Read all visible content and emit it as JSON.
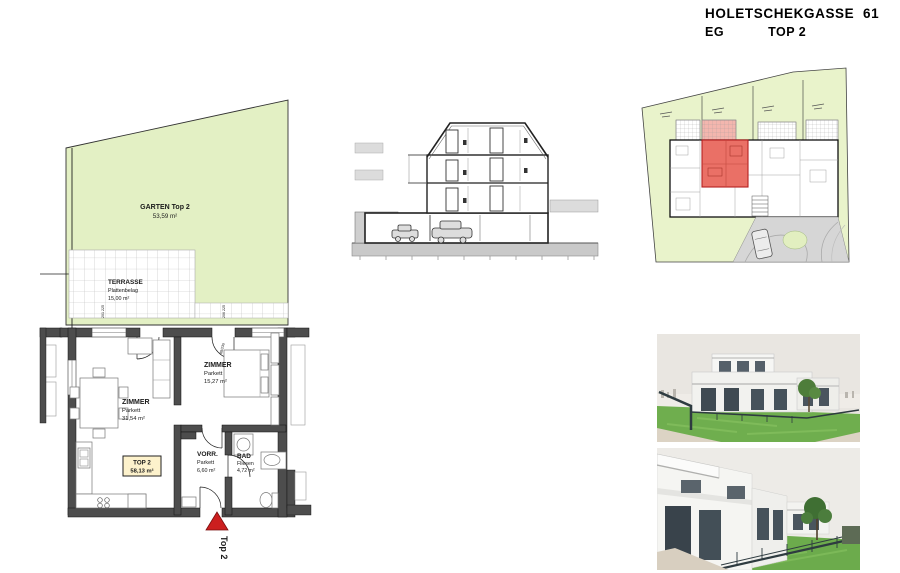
{
  "header": {
    "title": "HOLETSCHEKGASSE  61",
    "floor": "EG",
    "unit": "TOP 2"
  },
  "floor_plan": {
    "garden": {
      "name": "GARTEN Top 2",
      "area": "53,59 m²"
    },
    "terrace": {
      "name": "TERRASSE",
      "finish": "Plattenbelag",
      "area": "15,00 m²"
    },
    "living_room": {
      "name": "ZIMMER",
      "finish": "Parkett",
      "area": "31,54 m²"
    },
    "bedroom": {
      "name": "ZIMMER",
      "finish": "Parkett",
      "area": "15,27 m²"
    },
    "hall": {
      "name": "VORR.",
      "finish": "Parkett",
      "area": "6,60 m²"
    },
    "bath": {
      "name": "BAD",
      "finish": "Fliesen",
      "area": "4,72 m²"
    },
    "unit_box": {
      "label": "TOP 2",
      "area": "58,13 m²"
    },
    "entrance_marker": "Top 2",
    "dims": {
      "terrace_left": "201 225",
      "terrace_right": "206 225",
      "door_left": "82/230",
      "door_right": "88/230"
    }
  },
  "colors": {
    "garden_green": "#e3f0c4",
    "site_green": "#e9f3cb",
    "wall_gray": "#4d4d4d",
    "unit_highlight_red": "#ea7066",
    "marker_red": "#cc1f1f",
    "area_box_yellow": "#fdf2cc"
  }
}
